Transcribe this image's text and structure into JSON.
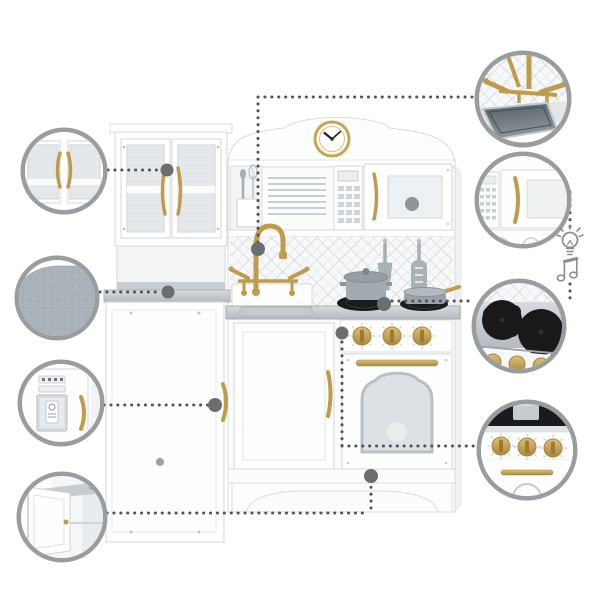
{
  "image": {
    "type": "product-feature-diagram",
    "subject": "white-and-gold-wooden-play-kitchen",
    "background": "#ffffff"
  },
  "palette": {
    "bg": "#ffffff",
    "gold": "#bf9c4c",
    "gold_dark": "#a8863c",
    "ring": "#9a9da0",
    "dot": "#6b6e71",
    "connector": "#515457",
    "icon": "#8b8f93",
    "counter_gray": "#c2c7cc",
    "burner_black": "#1a1b1e",
    "glass_gray": "#e5e8eb",
    "felt_gray": "#aab2b9",
    "steel_gray": "#6a747b"
  },
  "product": {
    "label": "play kitchen with hutch cabinet, refrigerator, clock, microwave, sink with gold faucet, stove and oven",
    "parts": [
      "glass-hutch-cabinet",
      "open-shelf",
      "refrigerator",
      "wall-clock",
      "utensil-crock",
      "plate-rack",
      "control-keypad",
      "microwave",
      "lattice-backsplash",
      "gold-faucet",
      "sink",
      "hanging-spatulas",
      "pot",
      "pan",
      "stove-burners",
      "oven-knobs",
      "oven-door-window",
      "sink-cabinet",
      "scalloped-apron"
    ]
  },
  "callouts": {
    "left": [
      {
        "label": "glass cabinet doors with gold handles detail"
      },
      {
        "label": "gray felt texture detail"
      },
      {
        "label": "refrigerator ice dispenser detail"
      },
      {
        "label": "open storage door detail"
      }
    ],
    "right": [
      {
        "label": "gold faucet and sink basin detail"
      },
      {
        "label": "microwave with keypad detail"
      },
      {
        "label": "stove burners detail"
      },
      {
        "label": "oven knobs and gold handle detail"
      }
    ]
  },
  "feature_icons": [
    {
      "name": "lightbulb-icon"
    },
    {
      "name": "music-notes-icon"
    }
  ]
}
